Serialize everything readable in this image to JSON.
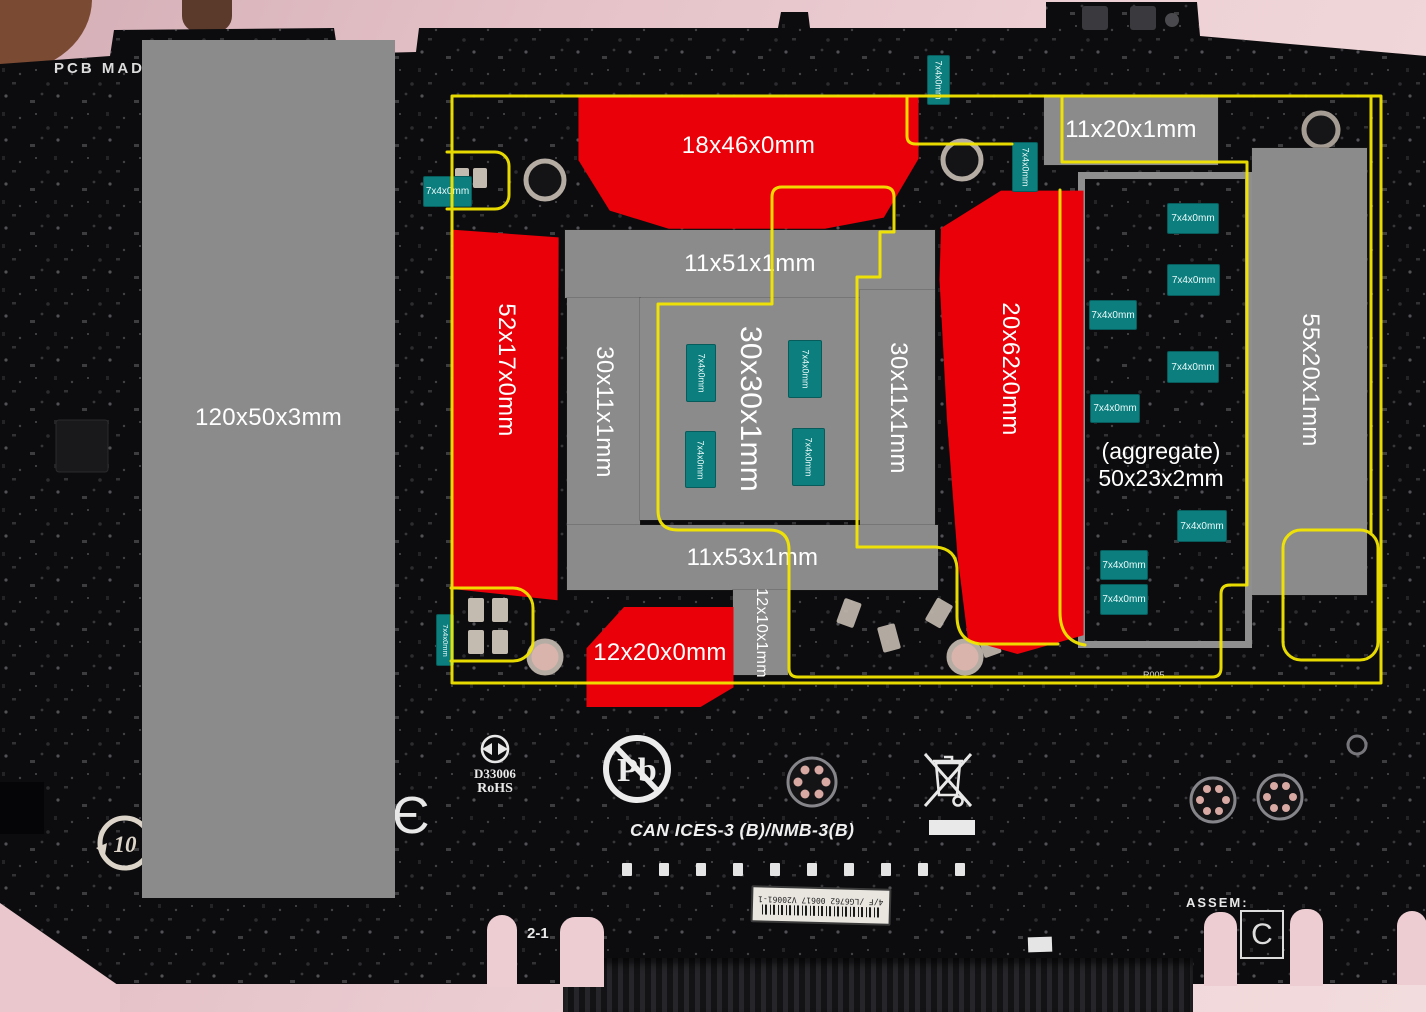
{
  "colors": {
    "annotation_yellow": "#f3e600",
    "annotation_red": "#ea0008",
    "annotation_gray": "#8b8b8b",
    "chip_teal": "#0c7e7e",
    "pcb_black": "#0c0c0e",
    "backdrop_pink": "#e6c3c9"
  },
  "measurements": {
    "gray_boxes": [
      {
        "id": "left-plate",
        "label": "120x50x3mm"
      },
      {
        "id": "top-right",
        "label": "11x20x1mm"
      },
      {
        "id": "center-top",
        "label": "11x51x1mm"
      },
      {
        "id": "center-left",
        "label": "30x11x1mm"
      },
      {
        "id": "center",
        "label": "30x30x1mm"
      },
      {
        "id": "center-right",
        "label": "30x11x1mm"
      },
      {
        "id": "center-bottom",
        "label": "11x53x1mm"
      },
      {
        "id": "below-center",
        "label": "12x10x1mm"
      },
      {
        "id": "right-tall",
        "label": "55x20x1mm"
      }
    ],
    "red_zones": [
      {
        "id": "top",
        "label": "18x46x0mm"
      },
      {
        "id": "left",
        "label": "52x17x0mm"
      },
      {
        "id": "right",
        "label": "20x62x0mm"
      },
      {
        "id": "bottom",
        "label": "12x20x0mm"
      }
    ],
    "chip_label": "7x4x0mm",
    "aggregate": {
      "line1": "(aggregate)",
      "line2": "50x23x2mm"
    }
  },
  "silkscreen": {
    "pcb_origin_text": "PCB MAD",
    "rohs_cert_number": "D33006",
    "rohs_text": "RoHS",
    "lead_free_symbol": "Pb",
    "emc_statement": "CAN ICES-3 (B)/NMB-3(B)",
    "panel_marking": "2-1",
    "efup_years": "10",
    "assembly_label": "ASSEM:",
    "assembly_revision": "C",
    "serial_sticker": "4/F /LG6762 00617 V20061-1",
    "resistor_ref": "R47",
    "resistor_ref_small": "R005",
    "ce_mark_partial": "Є"
  }
}
